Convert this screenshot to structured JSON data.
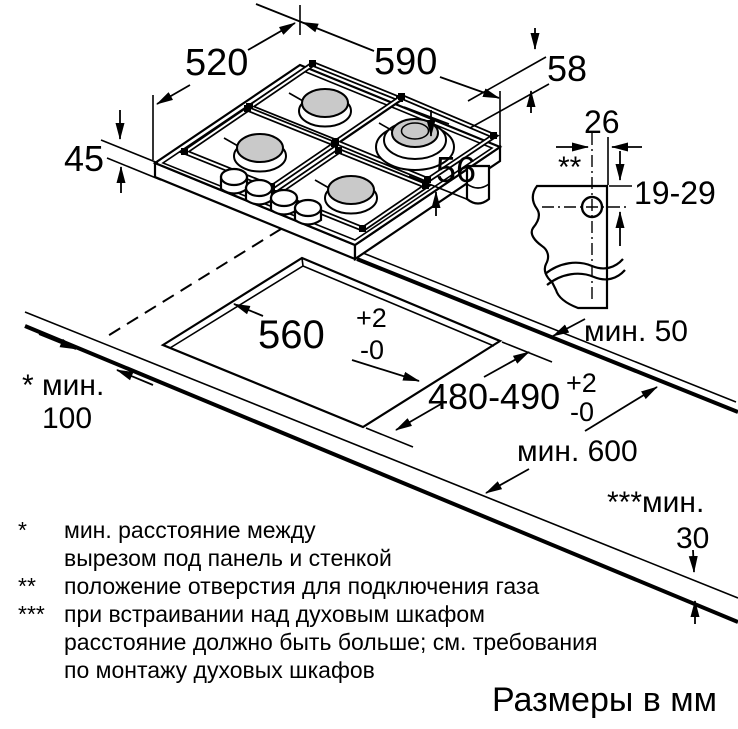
{
  "units_note": "Размеры в мм",
  "dimensions": {
    "hob_width": "590",
    "hob_depth": "520",
    "hob_height": "45",
    "hob_edge_height": "58",
    "hob_under_height": "56",
    "gas_hole_offset": "26",
    "gas_hole_marker": "**",
    "gas_hole_depth_range": "19-29",
    "cutout_width": "560",
    "cutout_width_tol_plus": "+2",
    "cutout_width_tol_minus": "-0",
    "cutout_depth": "480-490",
    "cutout_depth_tol_plus": "+2",
    "cutout_depth_tol_minus": "-0",
    "rear_clearance": "мин. 50",
    "worktop_depth": "мин. 600",
    "side_clearance_label": "* мин.",
    "side_clearance_value": "100",
    "bottom_clearance_label": "***мин.",
    "bottom_clearance_value": "30"
  },
  "footnotes": [
    {
      "marker": "*",
      "text": "мин. расстояние между"
    },
    {
      "marker": "",
      "text": "вырезом под панель и стенкой"
    },
    {
      "marker": "**",
      "text": "положение отверстия для подключения газа"
    },
    {
      "marker": "***",
      "text": "при встраивании над духовым шкафом"
    },
    {
      "marker": "",
      "text": "расстояние должно быть больше; см. требования"
    },
    {
      "marker": "",
      "text": "по монтажу духовых шкафов"
    }
  ]
}
